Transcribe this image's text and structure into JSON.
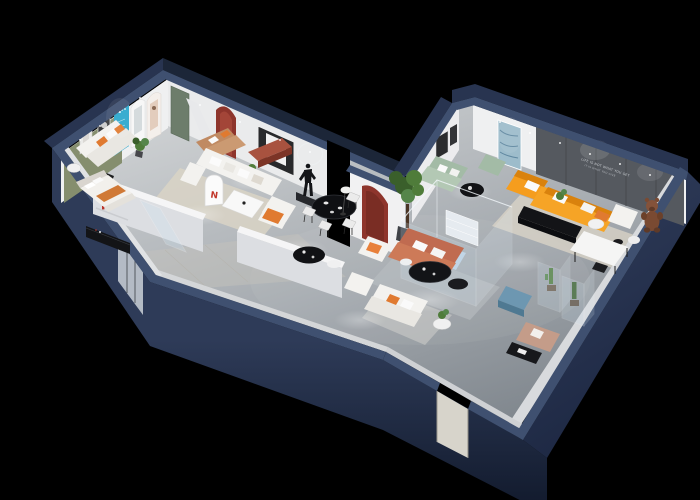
{
  "meta": {
    "type": "3d-isometric-floorplan-render",
    "subject": "Photoreal dollhouse cutaway render of a furniture showroom on a black background",
    "view": "axonometric from above, L-shaped plan with dark navy cutaway shell walls"
  },
  "palette": {
    "background": "#000000",
    "wall_top": "#3f5070",
    "wall_outer": "#283450",
    "wall_outer_dark": "#1c2638",
    "wall_inner_white": "#eff0f1",
    "wall_inner_shadow": "#d8dadd",
    "floor_light": "#cdd0d2",
    "floor_dark": "#868d94",
    "rug_cream": "#d9d3c5",
    "marble": "#d7d4cb",
    "accent_sage_wall": "#858e6e",
    "media_wall": "#55595f",
    "arch_cyan": "#2ba7cd",
    "arch_maroon": "#8e352c",
    "logo_red": "#c2382c",
    "door_green": "#6d7d6b",
    "sofa_white": "#f3f2ef",
    "sofa_cushion": "#e9e7e2",
    "sofa_tan": "#c08a62",
    "sofa_sage": "#a3bba6",
    "sofa_orange": "#f59d1e",
    "sofa_terracotta": "#c06b50",
    "sofa_paleblue": "#bdd2e4",
    "pillow_orange": "#e07a30",
    "bench_maroon": "#a8523f",
    "ottoman_blue": "#6d97b1",
    "chaise_blush": "#c49c89",
    "furniture_black": "#131417",
    "table_white": "#f5f5f4",
    "plant_green": "#4f7c3a",
    "plant_green_dark": "#3a5f2b",
    "plant_green_light": "#55854a",
    "teddy_brown": "#7a4a32",
    "glass_tint": "#cfe2ef"
  },
  "feature_wall": {
    "slogan_line1": "LIFE IS NOT WHAT YOU GET",
    "slogan_line2": "IT IS WHAT YOU GIVE"
  },
  "left_wing": {
    "arch_logo_letter": "N"
  },
  "exterior": {
    "shell": "dark navy cutaway walls with lighter top caps",
    "openings": [
      "glass entrance door bottom-left",
      "marble doorway bottom-right",
      "open notch doorway at center"
    ]
  },
  "rooms": [
    {
      "name": "display-room-back-left",
      "accent_wall": "sage green",
      "items": [
        "white fabric sofa with orange pillows",
        "two framed artworks",
        "round side table",
        "black chair",
        "potted plant",
        "cyan arched display panel",
        "arched niches with posters",
        "green door"
      ]
    },
    {
      "name": "sitting-room",
      "items": [
        "tan leather loveseat",
        "maroon leather bench",
        "round coffee table with plant",
        "red arched wall niche",
        "black framed artwork"
      ]
    },
    {
      "name": "bedroom",
      "items": [
        "double bed with white and orange bedding",
        "black low media console",
        "wall shelf with red decor"
      ]
    },
    {
      "name": "family-lounge",
      "items": [
        "white u-shaped sectional sofa",
        "white coffee table",
        "accent chair with orange cushion",
        "round wall ring",
        "black figure sculpture on plinth",
        "arched display panel with red logo",
        "black oval coffee table",
        "white side table",
        "cream rug"
      ]
    },
    {
      "name": "dining-area",
      "items": [
        "black dining table",
        "four white dining chairs",
        "white floor lamp",
        "white pillar with maroon arch"
      ]
    },
    {
      "name": "main-showroom",
      "items": [
        "orange l-shaped sectional with white pillows",
        "black media bench",
        "dark paneled feature wall with white slogan",
        "sage green sofa and chaise",
        "black round coffee table",
        "blue abstract painting",
        "small dark wall frames",
        "glass display room with pale blue sofa and white shelving",
        "indoor ficus tree",
        "terracotta sofa with white pillows",
        "white armchair with orange pillow",
        "black oval coffee tables",
        "white sofa set",
        "round side table with plant",
        "blue ottoman",
        "blush chaise lounge",
        "black side table with magazines",
        "white armchair",
        "brown teddy-bear figure",
        "white display table",
        "glass vitrines with cacti",
        "cream and gray area rugs"
      ]
    }
  ]
}
